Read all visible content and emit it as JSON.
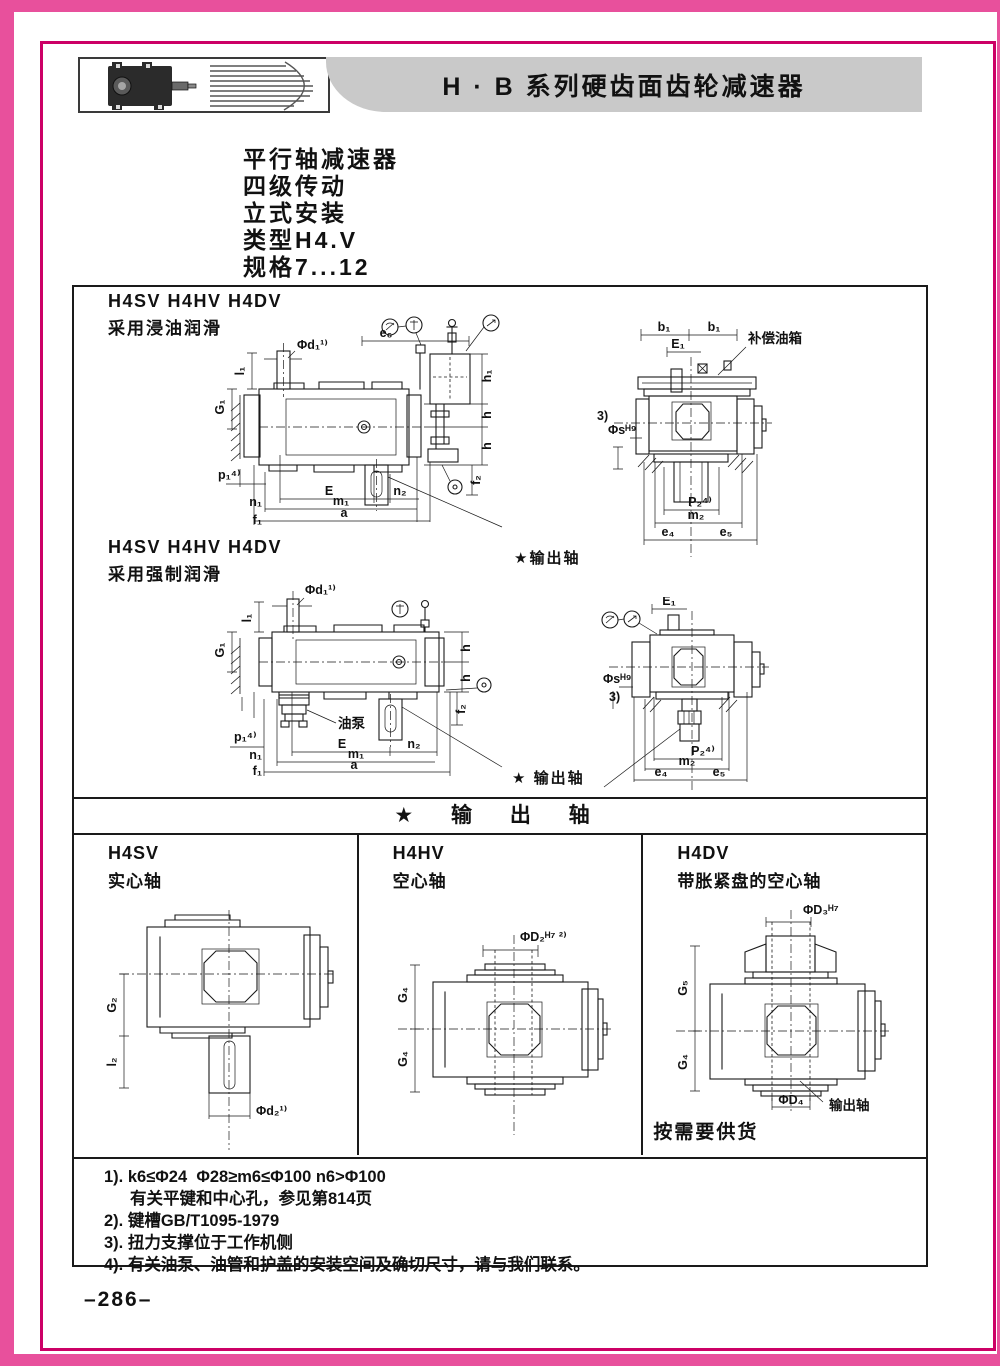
{
  "header": {
    "title": "H · B 系列硬齿面齿轮减速器"
  },
  "intro": {
    "lines": [
      "平行轴减速器",
      "四级传动",
      "立式安装",
      "类型H4.V",
      "规格7...12"
    ]
  },
  "sections": {
    "immersion": {
      "models": "H4SV H4HV H4DV",
      "lube": "采用浸油润滑",
      "output_label": "★输出轴"
    },
    "forced": {
      "models": "H4SV H4HV H4DV",
      "lube": "采用强制润滑",
      "output_label": "★ 输出轴"
    },
    "divider": "★ 输 出 轴"
  },
  "callouts": {
    "tank": "补偿油箱",
    "pump": "油泵",
    "out_shaft": "输出轴",
    "supply": "按需要供货"
  },
  "dims": {
    "phi_d1": "Φd₁¹⁾",
    "l1": "l₁",
    "G1": "G₁",
    "p1": "p₁⁴⁾",
    "n1": "n₁",
    "f1": "f₁",
    "E": "E",
    "n2": "n₂",
    "m1": "m₁",
    "a": "a",
    "e6": "e₆",
    "h1": "h₁",
    "h": "h",
    "f2": "f₂",
    "b1": "b₁",
    "E1": "E₁",
    "note3": "3)",
    "phi_s": "Φsᴴ⁹",
    "P2": "P₂⁴⁾",
    "m2": "m₂",
    "e4": "e₄",
    "e5": "e₅",
    "G2": "G₂",
    "l2": "l₂",
    "phi_d2": "Φd₂¹⁾",
    "phi_D2": "ΦD₂ᴴ⁷ ²⁾",
    "G4": "G₄",
    "phi_D3": "ΦD₃ᴴ⁷",
    "G5": "G₅",
    "phi_D4": "ΦD₄"
  },
  "columns": [
    {
      "model": "H4SV",
      "desc": "实心轴"
    },
    {
      "model": "H4HV",
      "desc": "空心轴"
    },
    {
      "model": "H4DV",
      "desc": "带胀紧盘的空心轴"
    }
  ],
  "footnotes": {
    "lines": [
      "1). k6≤Φ24  Φ28≥m6≤Φ100 n6>Φ100",
      "有关平键和中心孔，参见第814页",
      "2). 键槽GB/T1095-1979",
      "3). 扭力支撑位于工作机侧",
      "4). 有关油泵、油管和护盖的安装空间及确切尺寸，请与我们联系。"
    ]
  },
  "page": {
    "number": "–286–"
  },
  "colors": {
    "border_pink": "#e8509c",
    "frame_magenta": "#cc0066",
    "titlebar_gray": "#c9c9c9"
  }
}
